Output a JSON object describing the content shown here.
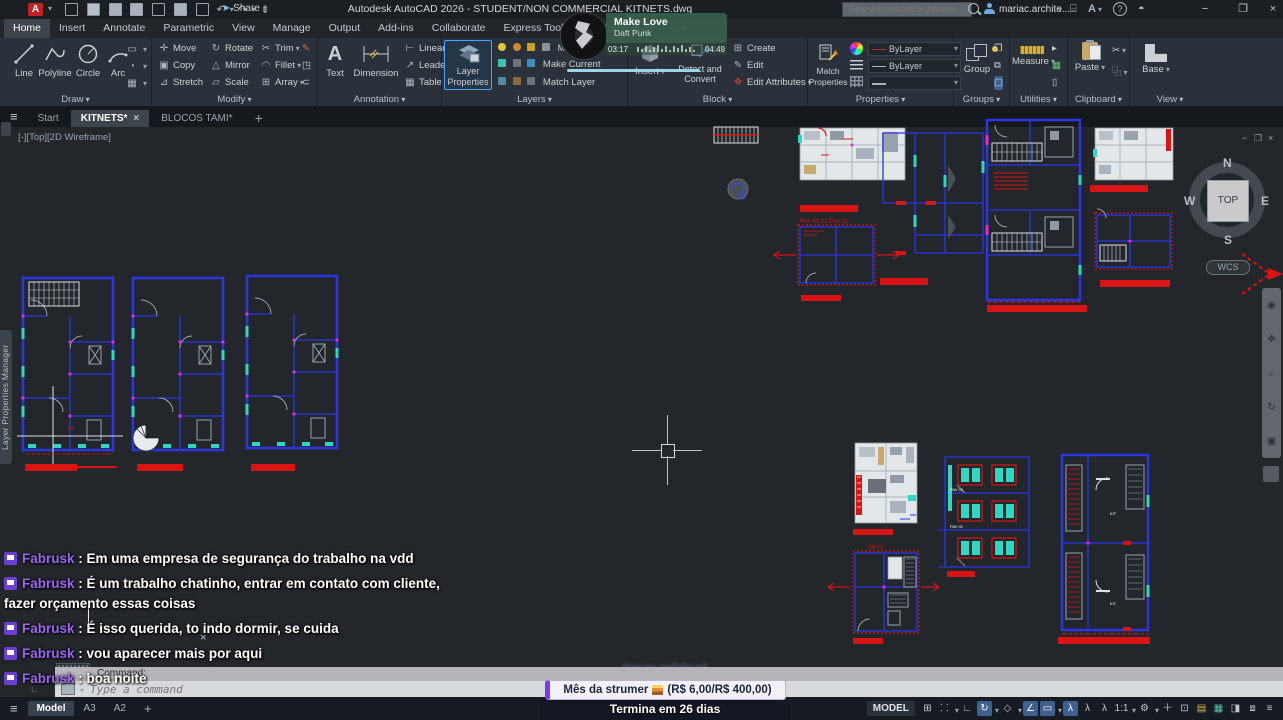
{
  "titlebar": {
    "title": "Autodesk AutoCAD 2026 - STUDENT/NON COMMERCIAL   KITNETS.dwg",
    "share": "Share",
    "search_placeholder": "Type a keyword or phrase",
    "account": "mariac.archite..."
  },
  "menu_tabs": [
    "Home",
    "Insert",
    "Annotate",
    "Parametric",
    "View",
    "Manage",
    "Output",
    "Add-ins",
    "Collaborate",
    "Express Tools",
    "Featured Apps"
  ],
  "ribbon": {
    "draw": {
      "label": "Draw",
      "line": "Line",
      "polyline": "Polyline",
      "circle": "Circle",
      "arc": "Arc"
    },
    "modify": {
      "label": "Modify",
      "move": "Move",
      "copy": "Copy",
      "stretch": "Stretch",
      "rotate": "Rotate",
      "mirror": "Mirror",
      "scale": "Scale",
      "trim": "Trim",
      "fillet": "Fillet",
      "array": "Array"
    },
    "annotation": {
      "label": "Annotation",
      "text": "Text",
      "dimension": "Dimension",
      "linear": "Linear",
      "leader": "Leader",
      "table": "Table"
    },
    "layers": {
      "label": "Layers",
      "layer_properties": "Layer Properties",
      "current_layer": "MOBIL",
      "make_current": "Make Current",
      "match_layer": "Match Layer"
    },
    "block": {
      "label": "Block",
      "insert": "Insert",
      "detect": "Detect and Convert",
      "create": "Create",
      "edit": "Edit",
      "edit_attributes": "Edit Attributes"
    },
    "properties": {
      "label": "Properties",
      "match_properties": "Match Properties",
      "bylayer_1": "ByLayer",
      "bylayer_2": "ByLayer"
    },
    "groups": {
      "label": "Groups",
      "group": "Group"
    },
    "utilities": {
      "label": "Utilities",
      "measure": "Measure"
    },
    "clipboard": {
      "label": "Clipboard",
      "paste": "Paste"
    },
    "view": {
      "label": "View",
      "base": "Base"
    }
  },
  "music_player": {
    "title": "Make Love",
    "artist": "Daft Punk",
    "elapsed": "03:17",
    "duration": "04:49"
  },
  "file_tabs": {
    "start": "Start",
    "kitnets": "KITNETS*",
    "blocos": "BLOCOS TAMI*"
  },
  "viewport": {
    "controls_label": "[-][Top][2D Wireframe]"
  },
  "viewcube": {
    "north": "N",
    "south": "S",
    "east": "E",
    "west": "W",
    "top": "TOP",
    "wcs": "WCS"
  },
  "palette": {
    "label": "Layer Properties Manager"
  },
  "chat": {
    "separator": " : ",
    "messages": [
      {
        "user": "Fabrusk",
        "text": "Em uma empresa de segurança do trabalho na vdd"
      },
      {
        "user": "Fabrusk",
        "text": "É um trabalho chatinho, entrar em contato com cliente, fazer orçamento essas coisas"
      },
      {
        "user": "Fabrusk",
        "text": "É isso querida, to indo dormir, se cuida"
      },
      {
        "user": "Fabrusk",
        "text": "vou aparecer mais por aqui"
      },
      {
        "user": "Fabrusk",
        "text": "boa noite"
      }
    ]
  },
  "command_line": {
    "history": "Command:",
    "placeholder": "Type a command"
  },
  "goal_widget": {
    "watermark": "doacao.gg/fabrusk",
    "title": "Mês da strumer",
    "amount": "(R$ 6,00/R$ 400,00)",
    "footer": "Termina em 26 dias"
  },
  "status_bar": {
    "model_tab": "Model",
    "layout_a3": "A3",
    "layout_a2": "A2",
    "model_badge": "MODEL",
    "scale": "1:1"
  },
  "colors": {
    "cad_blue": "#2a36e6",
    "cad_red": "#d81414",
    "twitch_purple": "#9b66f0",
    "accent_blue": "#4aa3ff",
    "goal_purple": "#7c3aed"
  }
}
